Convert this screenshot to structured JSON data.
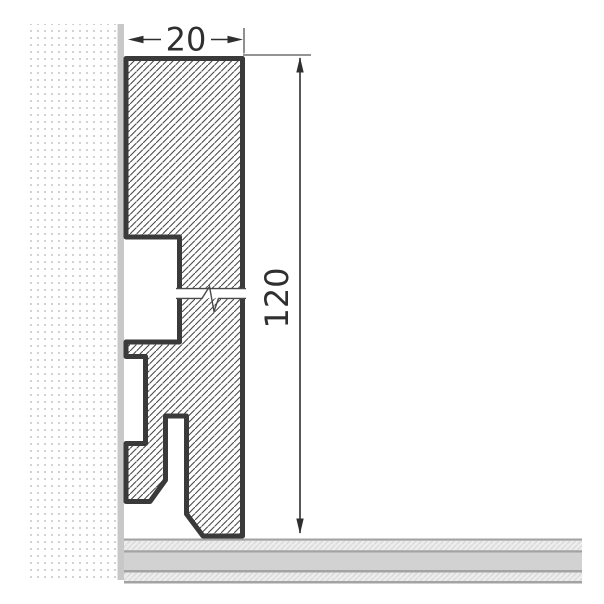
{
  "drawing": {
    "width_dimension": {
      "label": "20"
    },
    "height_dimension": {
      "label": "120"
    }
  },
  "parts": {
    "wall": "wall-texture",
    "wall_surface": "wall-surface-strip",
    "profile": "skirting-board-profile",
    "break": "break-line",
    "floor": "floor-layers"
  },
  "colors": {
    "background": "#ffffff",
    "outline": "#3a3a3a",
    "hatch_line": "#4a4a4a",
    "dimension_line": "#2f2f2f",
    "break_line": "#4a4a4a",
    "wall_surface": "#c8c8c8",
    "wall_dot": "#d2d2d2",
    "floor_solid_band": "#d2d2d2",
    "floor_hatched_band": "#ededed",
    "floor_hatch_line": "#d8d8d8",
    "floor_divider": "#a3a3a3"
  }
}
